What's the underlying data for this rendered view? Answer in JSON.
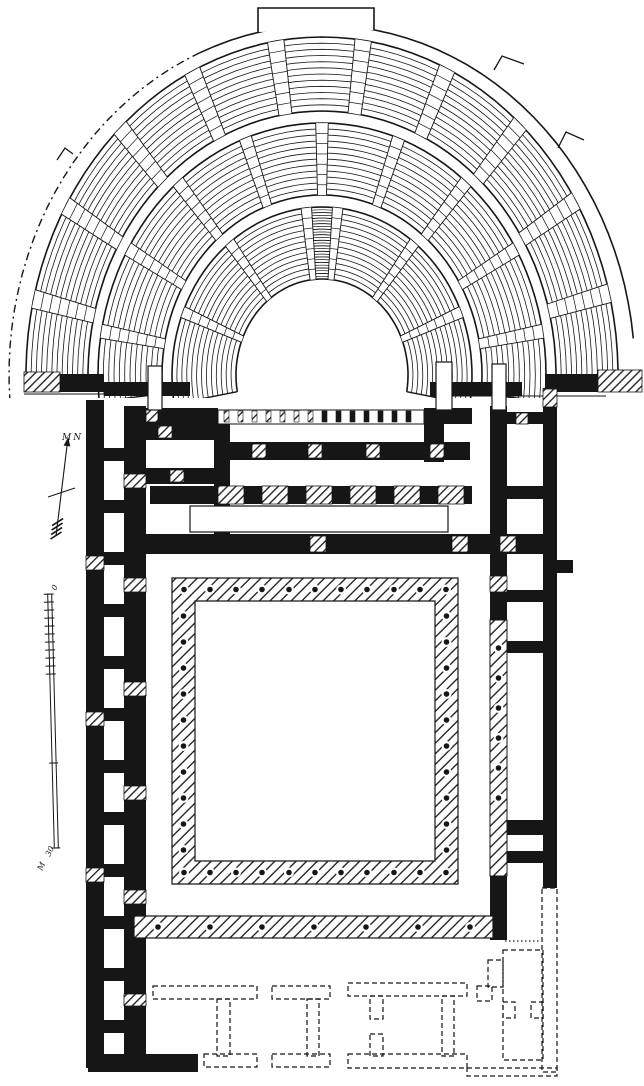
{
  "labels": {
    "north": "MN",
    "scale_zero": "0",
    "scale_thirty": "30",
    "scale_unit": "M"
  },
  "colors": {
    "ink": "#161616",
    "paper": "#ffffff"
  },
  "cavea": {
    "cx": 322,
    "cy": 375,
    "bands": [
      {
        "rx0": 86,
        "ry0": 96,
        "rx1": 150,
        "ry1": 168,
        "rows": 13,
        "a0": -10,
        "a1": 190,
        "stairs": [
          22,
          52,
          84,
          96,
          128,
          158
        ],
        "stair_w": 2.0,
        "dense": [
          86,
          94
        ]
      },
      {
        "rx0": 160,
        "ry0": 180,
        "rx1": 224,
        "ry1": 252,
        "rows": 12,
        "a0": -6,
        "a1": 186,
        "stairs": [
          10,
          30,
          50,
          70,
          90,
          110,
          130,
          150,
          170
        ],
        "stair_w": 1.6
      },
      {
        "rx0": 234,
        "ry0": 264,
        "rx1": 296,
        "ry1": 338,
        "rows": 12,
        "a0": -2,
        "a1": 182,
        "stairs": [
          14,
          31,
          48,
          65,
          82,
          99,
          116,
          133,
          150,
          167
        ],
        "stair_w": 1.6
      }
    ],
    "boundary": {
      "rx": 313,
      "ry": 350,
      "solid": [
        6,
        113
      ],
      "dashed": [
        113,
        184
      ],
      "bump": [
        258,
        32,
        258,
        8,
        374,
        8,
        374,
        30
      ],
      "steps": [
        [
          494,
          70,
          502,
          56,
          524,
          64
        ],
        [
          558,
          148,
          566,
          132,
          584,
          140
        ],
        [
          57,
          160,
          65,
          148,
          73,
          154
        ]
      ]
    },
    "mask": [
      0,
      398,
      644,
      46
    ],
    "baselines": [
      [
        24,
        394,
        190,
        394
      ],
      [
        430,
        396,
        606,
        396
      ]
    ]
  },
  "walls": {
    "black": [
      [
        86,
        400,
        18,
        668
      ],
      [
        124,
        406,
        22,
        656
      ],
      [
        104,
        448,
        20,
        13
      ],
      [
        104,
        500,
        20,
        13
      ],
      [
        104,
        552,
        20,
        13
      ],
      [
        104,
        604,
        20,
        13
      ],
      [
        104,
        656,
        20,
        13
      ],
      [
        104,
        708,
        20,
        13
      ],
      [
        104,
        760,
        20,
        13
      ],
      [
        104,
        812,
        20,
        13
      ],
      [
        104,
        864,
        20,
        13
      ],
      [
        104,
        916,
        20,
        13
      ],
      [
        104,
        968,
        20,
        13
      ],
      [
        104,
        1020,
        20,
        13
      ],
      [
        88,
        1054,
        110,
        18
      ],
      [
        134,
        982,
        12,
        10
      ],
      [
        58,
        374,
        46,
        18
      ],
      [
        104,
        382,
        86,
        14
      ],
      [
        430,
        382,
        92,
        14
      ],
      [
        545,
        374,
        62,
        18
      ],
      [
        140,
        408,
        78,
        16
      ],
      [
        424,
        408,
        48,
        16
      ],
      [
        214,
        424,
        16,
        112
      ],
      [
        424,
        424,
        20,
        38
      ],
      [
        214,
        442,
        256,
        18
      ],
      [
        146,
        424,
        68,
        16
      ],
      [
        146,
        468,
        68,
        16
      ],
      [
        150,
        486,
        68,
        18
      ],
      [
        244,
        486,
        18,
        18
      ],
      [
        288,
        486,
        18,
        18
      ],
      [
        332,
        486,
        18,
        18
      ],
      [
        376,
        486,
        18,
        18
      ],
      [
        420,
        486,
        18,
        18
      ],
      [
        464,
        486,
        8,
        18
      ],
      [
        140,
        534,
        405,
        20
      ],
      [
        490,
        406,
        17,
        170
      ],
      [
        490,
        592,
        17,
        28
      ],
      [
        490,
        876,
        17,
        64
      ],
      [
        543,
        388,
        14,
        500
      ],
      [
        557,
        560,
        16,
        13
      ],
      [
        507,
        412,
        36,
        12
      ],
      [
        507,
        486,
        36,
        13
      ],
      [
        507,
        539,
        36,
        12
      ],
      [
        507,
        590,
        36,
        12
      ],
      [
        507,
        641,
        36,
        12
      ],
      [
        507,
        820,
        36,
        15
      ],
      [
        507,
        851,
        36,
        12
      ]
    ],
    "hatch": [
      [
        24,
        372,
        36,
        20
      ],
      [
        598,
        370,
        44,
        22
      ],
      [
        252,
        444,
        14,
        14
      ],
      [
        308,
        444,
        14,
        14
      ],
      [
        366,
        444,
        14,
        14
      ],
      [
        430,
        444,
        14,
        14
      ],
      [
        218,
        486,
        26,
        18
      ],
      [
        262,
        486,
        26,
        18
      ],
      [
        306,
        486,
        26,
        18
      ],
      [
        350,
        486,
        26,
        18
      ],
      [
        394,
        486,
        26,
        18
      ],
      [
        438,
        486,
        26,
        18
      ],
      [
        310,
        536,
        16,
        16
      ],
      [
        452,
        536,
        16,
        16
      ],
      [
        500,
        536,
        16,
        16
      ],
      [
        158,
        426,
        14,
        12
      ],
      [
        170,
        470,
        14,
        12
      ],
      [
        146,
        410,
        12,
        12
      ],
      [
        124,
        474,
        22,
        14
      ],
      [
        124,
        578,
        22,
        14
      ],
      [
        124,
        682,
        22,
        14
      ],
      [
        124,
        786,
        22,
        14
      ],
      [
        124,
        890,
        22,
        14
      ],
      [
        124,
        994,
        22,
        12
      ],
      [
        86,
        556,
        18,
        14
      ],
      [
        86,
        712,
        18,
        14
      ],
      [
        86,
        868,
        18,
        14
      ],
      [
        490,
        576,
        17,
        16
      ],
      [
        543,
        389,
        14,
        18
      ],
      [
        516,
        413,
        12,
        11
      ],
      [
        214,
        520,
        16,
        12
      ]
    ],
    "outline": [
      [
        148,
        366,
        14,
        44
      ],
      [
        436,
        362,
        16,
        48
      ],
      [
        492,
        364,
        14,
        46
      ],
      [
        190,
        506,
        258,
        26
      ]
    ]
  },
  "colonnade_ticks": {
    "band": [
      218,
      410,
      206,
      14
    ],
    "x0": 224,
    "step": 14,
    "count": 14,
    "y": 411,
    "w": 5,
    "h": 11,
    "hatch_count": 7
  },
  "ring": {
    "outer": [
      172,
      578,
      286,
      306
    ],
    "inner": [
      195,
      601,
      240,
      260
    ],
    "dots": {
      "xs": [
        184,
        210,
        236,
        262,
        289,
        315,
        341,
        367,
        394,
        420,
        446
      ],
      "top_y": 589.5,
      "bottom_y": 872.5,
      "ys": [
        616,
        642,
        668,
        694,
        720,
        746,
        772,
        798,
        824,
        850
      ],
      "left_x": 183.5,
      "right_x": 446.5
    }
  },
  "strip": {
    "rect": [
      134,
      916,
      359,
      22
    ],
    "dot_y": 927,
    "dot_xs": [
      158,
      210,
      262,
      314,
      366,
      418,
      470
    ]
  },
  "right_strip": {
    "rect": [
      490,
      620,
      17,
      256
    ],
    "dot_x": 498.5,
    "dot_ys": [
      648,
      678,
      708,
      738,
      768,
      798
    ]
  },
  "dashed_rects": [
    [
      153,
      986,
      104,
      13
    ],
    [
      217,
      999,
      13,
      57
    ],
    [
      204,
      1054,
      53,
      13
    ],
    [
      272,
      986,
      58,
      13
    ],
    [
      307,
      999,
      12,
      57
    ],
    [
      272,
      1054,
      58,
      13
    ],
    [
      348,
      983,
      119,
      13
    ],
    [
      370,
      996,
      13,
      23
    ],
    [
      370,
      1034,
      13,
      22
    ],
    [
      442,
      996,
      12,
      60
    ],
    [
      348,
      1054,
      119,
      14
    ],
    [
      477,
      986,
      15,
      15
    ],
    [
      488,
      960,
      15,
      27
    ],
    [
      503,
      950,
      40,
      110
    ],
    [
      503,
      1002,
      12,
      16
    ],
    [
      531,
      1002,
      12,
      16
    ],
    [
      542,
      888,
      15,
      184
    ],
    [
      467,
      1068,
      90,
      8
    ]
  ],
  "dotted_lines": [
    [
      505,
      941,
      541,
      941
    ]
  ],
  "north_arrow": {
    "x1": 56,
    "y1": 536,
    "x2": 67,
    "y2": 446,
    "crossbar": [
      48,
      497,
      75,
      488
    ]
  },
  "scale_bar": {
    "x": 53,
    "top": 594,
    "bottom": 848,
    "tick_step": 8,
    "tick_count": 11,
    "mid_tick": 763,
    "tilt": -1.5
  }
}
